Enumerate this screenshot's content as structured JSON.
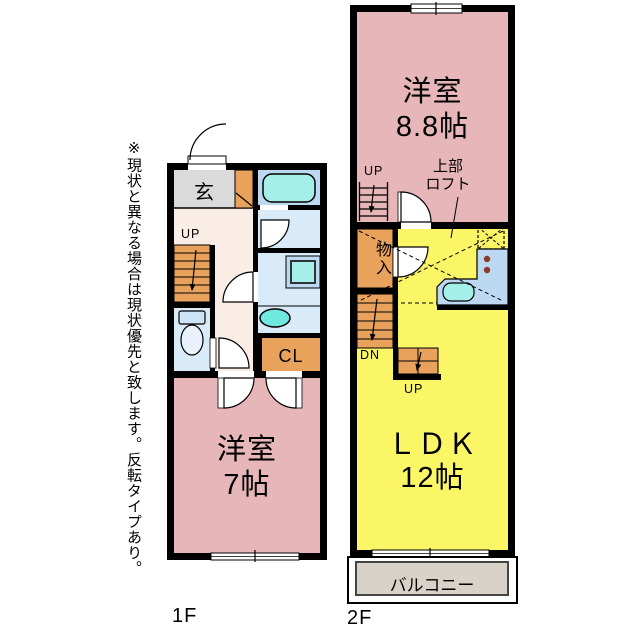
{
  "side_note": "※現状と異なる場合は現状優先と致します。反転タイプあり。",
  "floor_1f": {
    "floor_label": "1F",
    "genkan_label": "玄",
    "stairs_label": "UP",
    "closet_label": "CL",
    "bedroom": {
      "name": "洋室",
      "size": "7帖"
    }
  },
  "floor_2f": {
    "floor_label": "2F",
    "bedroom": {
      "name": "洋室",
      "size": "8.8帖"
    },
    "loft_ladder_label": "UP",
    "loft_note": {
      "line1": "上部",
      "line2": "ロフト"
    },
    "storage_label": "物入",
    "stairs_down_label": "DN",
    "stairs_up_label": "UP",
    "ldk": {
      "name": "ＬＤＫ",
      "size": "12帖"
    },
    "balcony_label": "バルコニー"
  },
  "colors": {
    "wall": "#000000",
    "pink": "#E7B6B9",
    "yellow": "#FAF666",
    "orange": "#E9A25B",
    "cream": "#FAEDE6",
    "gray": "#DADADA",
    "light_blue": "#D9EAF8",
    "mid_blue": "#BDD9F2",
    "tub_cyan": "#A5EFEA",
    "fixture_cyan": "#6FE9DF",
    "balcony": "#D9D2C9"
  }
}
